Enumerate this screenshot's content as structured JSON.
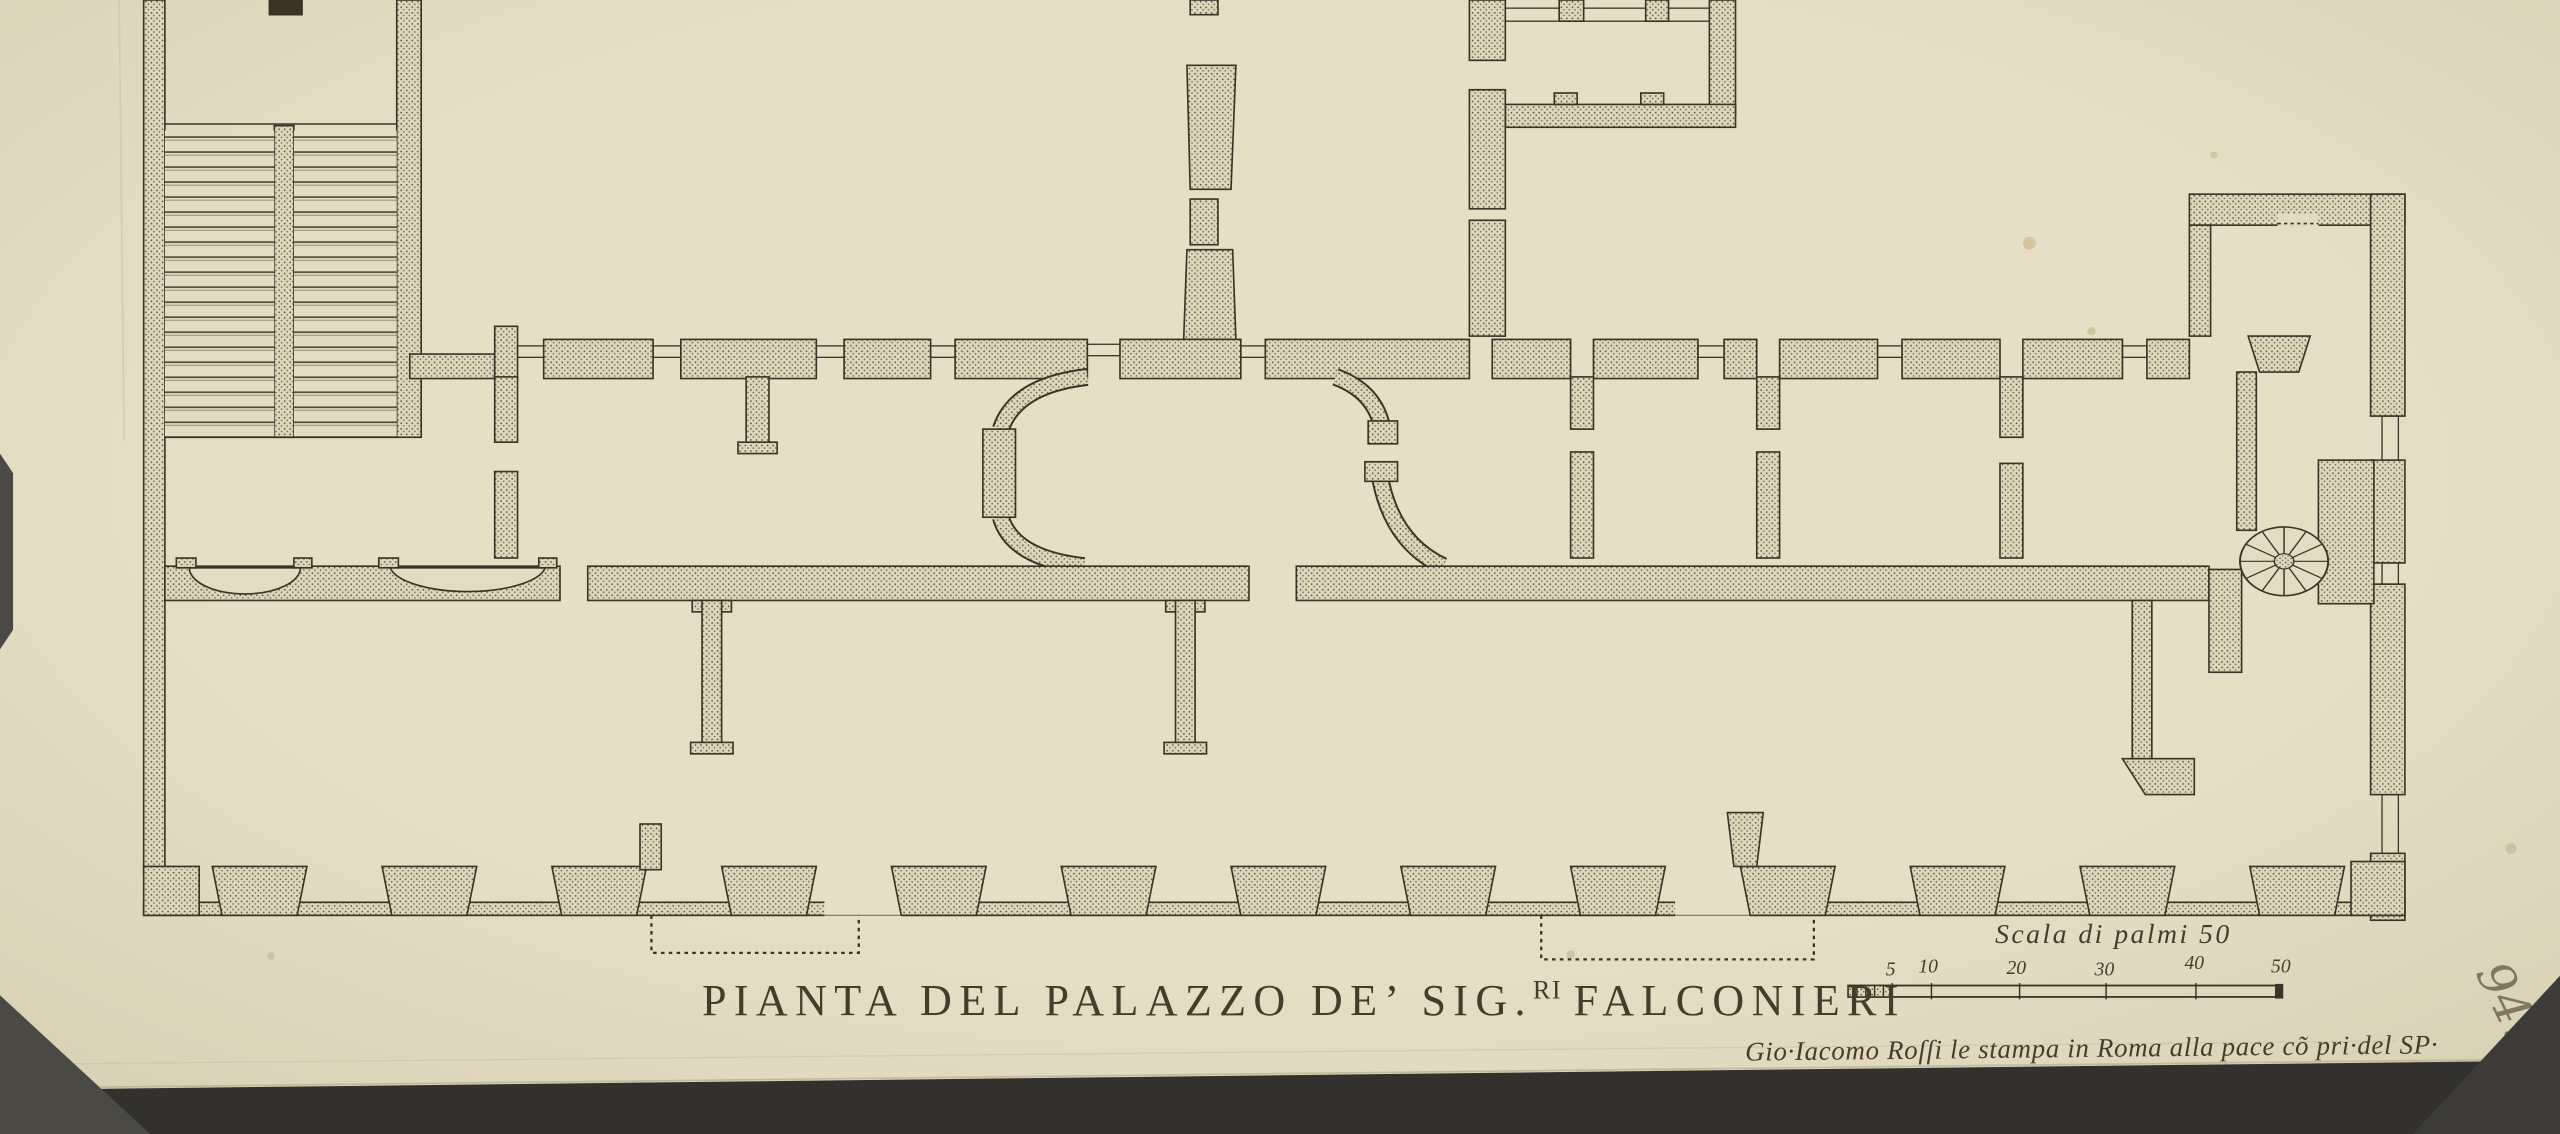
{
  "artwork": {
    "kind": "engraved-floor-plan",
    "title": {
      "prefix": "PIANTA DEL PALAZZO DE’ SIG.",
      "superscript": "RI",
      "suffix": "FALCONIERI"
    },
    "imprint": "Gio·Iacomo Roſſi le stampa in Roma alla pace cõ pri·del SP·",
    "collection_number": "94.",
    "collection_number_suffix": "e"
  },
  "scale_bar": {
    "label": "Scala di palmi 50",
    "tick_labels": [
      "5",
      "10",
      "20",
      "30",
      "40",
      "50"
    ]
  },
  "colors": {
    "paper": "#e6dfc6",
    "paper_shade": "#ddd5b8",
    "ink": "#3b3327",
    "stipple_dot": "#564e3a",
    "backdrop_dark": "#32312d",
    "backdrop_gray": "#4a4944",
    "graphite": "#6f6753"
  }
}
